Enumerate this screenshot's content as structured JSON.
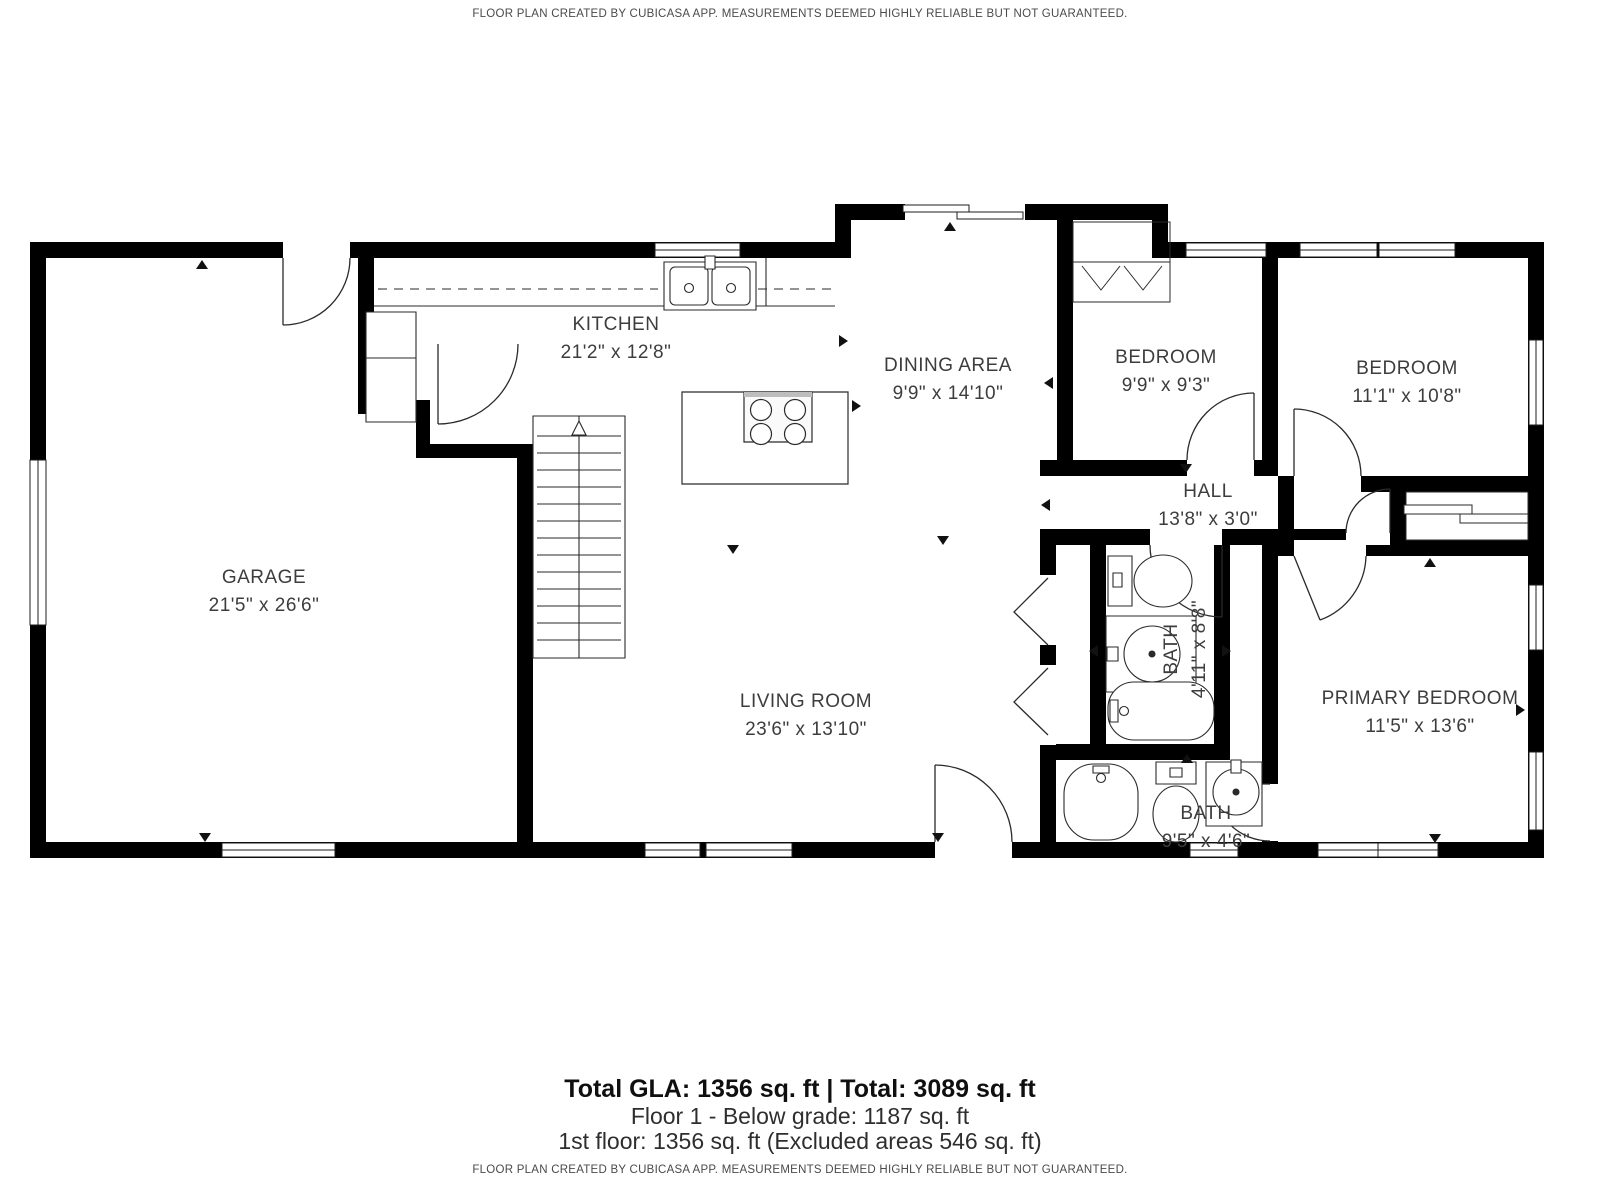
{
  "header": {
    "disclaimer": "FLOOR PLAN CREATED BY CUBICASA APP. MEASUREMENTS DEEMED HIGHLY RELIABLE BUT NOT GUARANTEED."
  },
  "rooms": [
    {
      "id": "kitchen",
      "name": "KITCHEN",
      "dims": "21'2\" x 12'8\""
    },
    {
      "id": "dining-area",
      "name": "DINING AREA",
      "dims": "9'9\" x 14'10\""
    },
    {
      "id": "bedroom-1",
      "name": "BEDROOM",
      "dims": "9'9\" x 9'3\""
    },
    {
      "id": "bedroom-2",
      "name": "BEDROOM",
      "dims": "11'1\" x 10'8\""
    },
    {
      "id": "hall",
      "name": "HALL",
      "dims": "13'8\" x 3'0\""
    },
    {
      "id": "garage",
      "name": "GARAGE",
      "dims": "21'5\" x 26'6\""
    },
    {
      "id": "living-room",
      "name": "LIVING ROOM",
      "dims": "23'6\" x 13'10\""
    },
    {
      "id": "bath-1",
      "name": "BATH",
      "dims": "4'11\" x 8'8\""
    },
    {
      "id": "primary-bedroom",
      "name": "PRIMARY BEDROOM",
      "dims": "11'5\" x 13'6\""
    },
    {
      "id": "bath-2",
      "name": "BATH",
      "dims": "9'5\" x 4'6\""
    }
  ],
  "summary": {
    "total_line": "Total GLA: 1356 sq. ft | Total: 3089 sq. ft",
    "floor1_line": "Floor 1 - Below grade: 1187 sq. ft",
    "first_floor_line": "1st floor: 1356 sq. ft (Excluded areas 546 sq. ft)",
    "disclaimer": "FLOOR PLAN CREATED BY CUBICASA APP. MEASUREMENTS DEEMED HIGHLY RELIABLE BUT NOT GUARANTEED."
  },
  "colors": {
    "wall": "#000000",
    "background": "#ffffff",
    "label_text": "#3d3d3d",
    "fixture_stroke": "#2a2a2a"
  }
}
